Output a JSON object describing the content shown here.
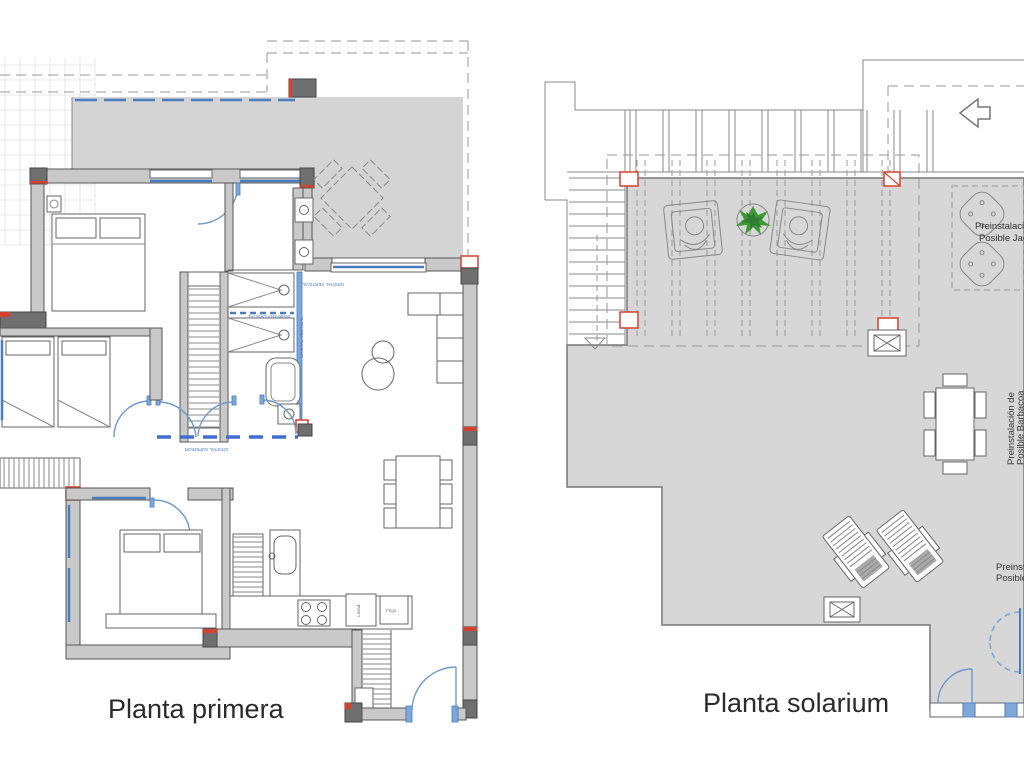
{
  "plans": {
    "left": {
      "title": "Planta primera"
    },
    "right": {
      "title": "Planta solarium"
    }
  },
  "annotations": {
    "jacuzzi_line1": "Preinstalación",
    "jacuzzi_line2": "Posible Jacuzzi",
    "side_line1": "Preinstalación de",
    "side_line2": "Posible Barbacoa",
    "corner_line1": "Preinstalación",
    "corner_line2": "Posible",
    "win_terrace": "CRISTAL VERTICAL",
    "win_corridor": "CRISTAL SUPERIOR",
    "win_shower": "MAMPARA CRISTAL",
    "win_bath": "CRISTAL VERTICAL",
    "kitchen_fridge": "Frigo",
    "kitchen_appliance": "Lavad."
  },
  "colors": {
    "wall_fill": "#c9c9c9",
    "wall_dark": "#6f6f6f",
    "accent_red": "#d5402f",
    "terrace_gray": "#d4d4d4",
    "floor_gray": "#d7d7d7",
    "window_blue": "#4a7cc0",
    "plant_green": "#3e9a35"
  }
}
